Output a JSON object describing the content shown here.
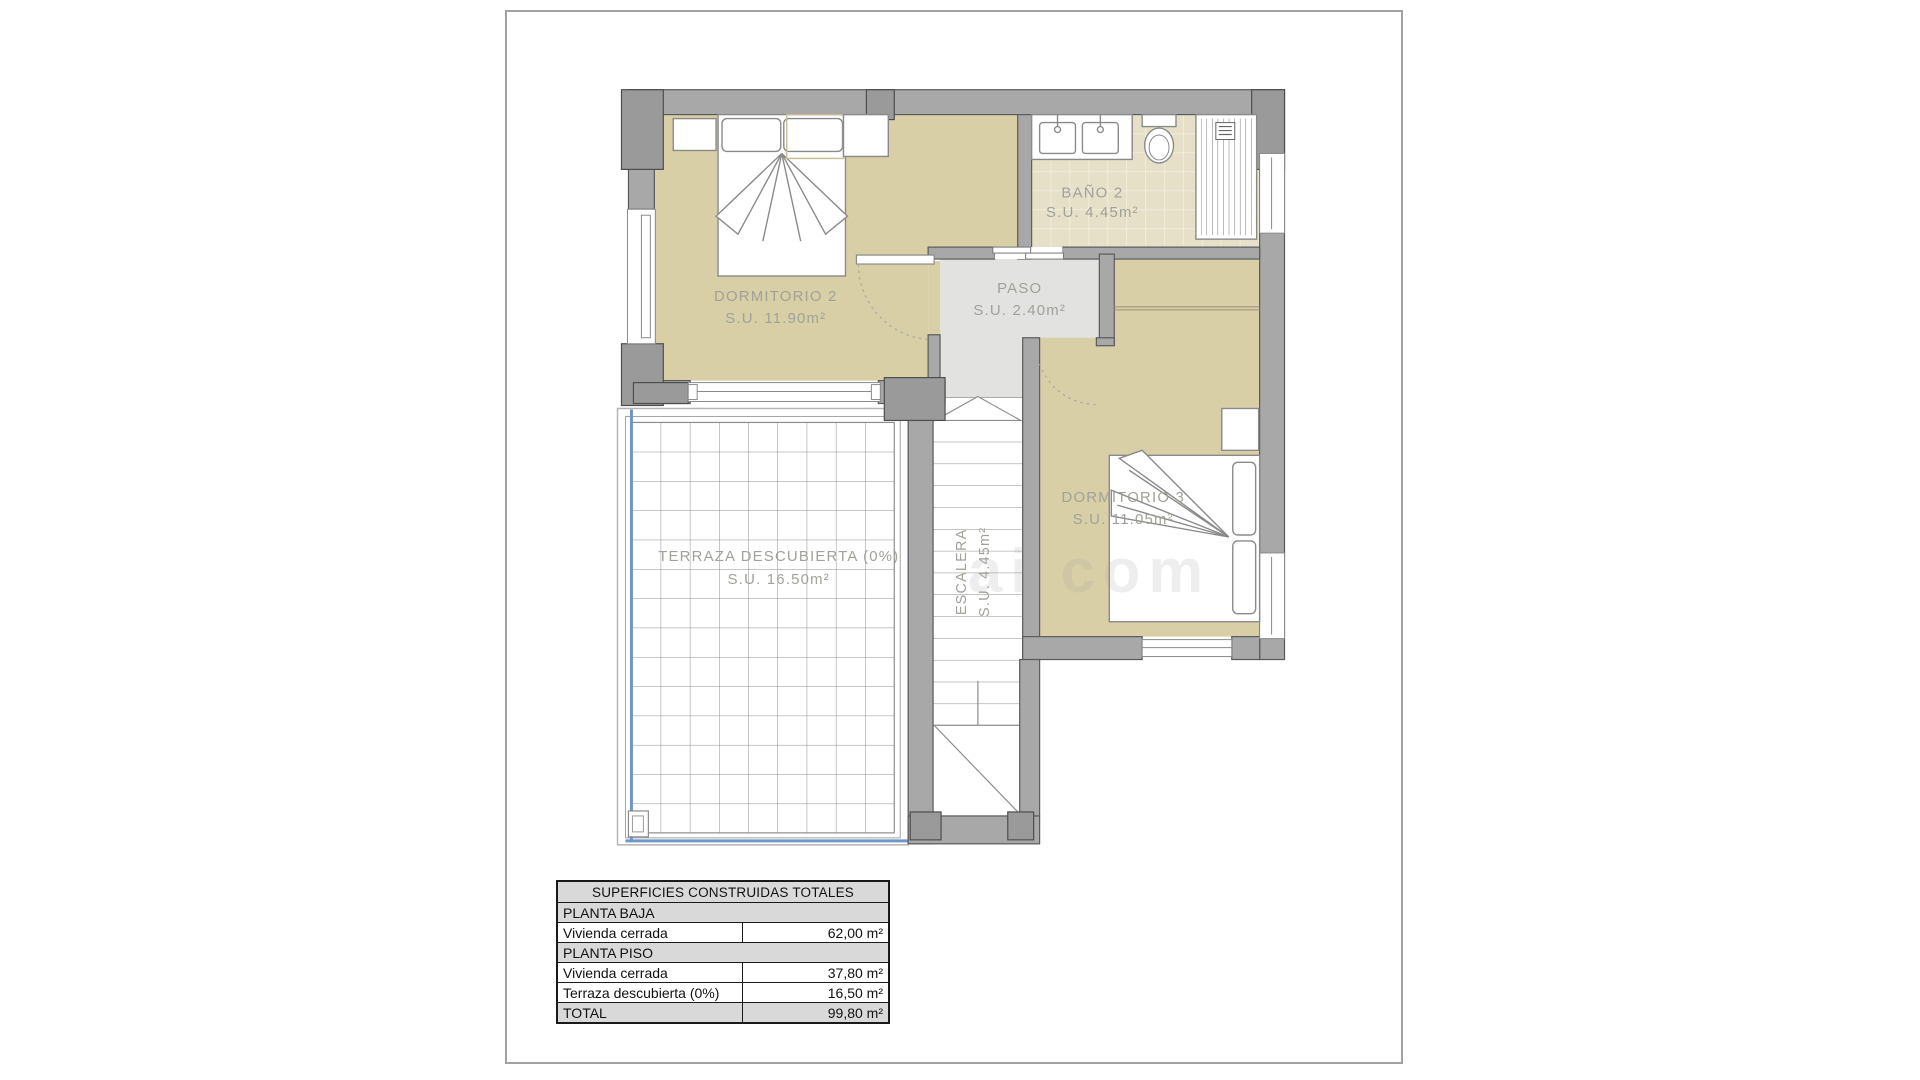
{
  "plan": {
    "rooms": [
      {
        "id": "dormitorio-2",
        "name": "DORMITORIO 2",
        "area": "S.U. 11.90m²"
      },
      {
        "id": "bano-2",
        "name": "BAÑO 2",
        "area": "S.U. 4.45m²"
      },
      {
        "id": "paso",
        "name": "PASO",
        "area": "S.U. 2.40m²"
      },
      {
        "id": "dormitorio-3",
        "name": "DORMITORIO 3",
        "area": "S.U. 11.05m²"
      },
      {
        "id": "escalera",
        "name": "ESCALERA",
        "area": "S.U. 4.45m²"
      },
      {
        "id": "terraza",
        "name": "TERRAZA DESCUBIERTA (0%)",
        "area": "S.U. 16.50m²"
      }
    ],
    "colors": {
      "wall": "#a8a8a8",
      "wall_dark": "#9a9a9a",
      "room_fill": "#d9cfa6",
      "tile_fill": "#e7e0c9",
      "paso_fill": "#e2e2e1",
      "accent_blue": "#6e96c8",
      "label": "#a1a199"
    },
    "watermark": "ai com"
  },
  "table": {
    "title": "SUPERFICIES CONSTRUIDAS TOTALES",
    "sections": [
      {
        "header": "PLANTA BAJA",
        "rows": [
          {
            "label": "Vivienda cerrada",
            "value": "62,00 m²"
          }
        ]
      },
      {
        "header": "PLANTA PISO",
        "rows": [
          {
            "label": "Vivienda cerrada",
            "value": "37,80 m²"
          },
          {
            "label": "Terraza descubierta (0%)",
            "value": "16,50 m²"
          }
        ]
      }
    ],
    "total": {
      "label": "TOTAL",
      "value": "99,80 m²"
    }
  }
}
